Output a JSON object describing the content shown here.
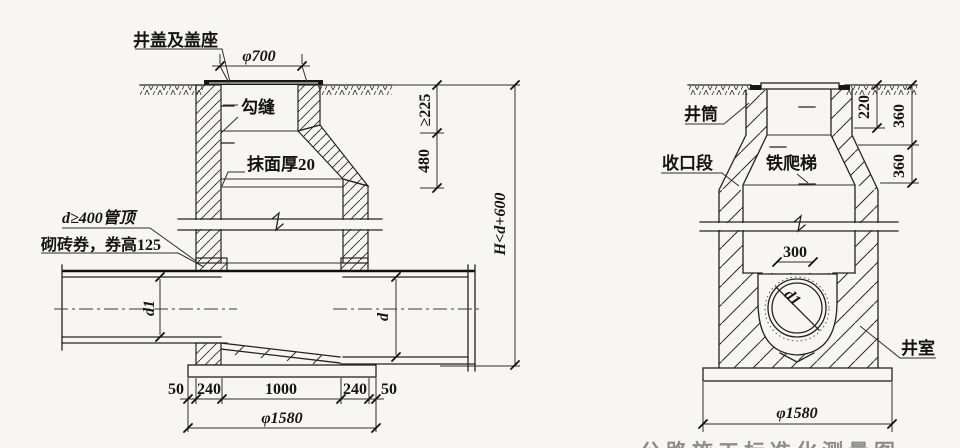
{
  "caption": "公路施工标准化测量图",
  "colors": {
    "paper": "#f7f6f3",
    "line": "#232323",
    "ink": "#141414"
  },
  "left_figure": {
    "labels": {
      "cover_seat": "井盖及盖座",
      "joint": "勾缝",
      "plaster": "抹面厚20",
      "pipe_note": "d≥400管顶",
      "arch_note": "砌砖券，券高125"
    },
    "dims": {
      "cover_dia": "φ700",
      "depth_top": "≥225",
      "cone_height": "480",
      "total_height": "H<d+600",
      "pipe_left": "d1",
      "pipe_right": "d",
      "row": [
        "50",
        "240",
        "1000",
        "240",
        "50"
      ],
      "base_dia": "φ1580"
    }
  },
  "right_figure": {
    "labels": {
      "shaft": "井筒",
      "taper": "收口段",
      "ladder": "铁爬梯",
      "chamber": "井室"
    },
    "dims": {
      "neck": "220",
      "upper": "360",
      "lower": "360",
      "opening": "300",
      "pipe": "d1",
      "base_dia": "φ1580"
    }
  }
}
